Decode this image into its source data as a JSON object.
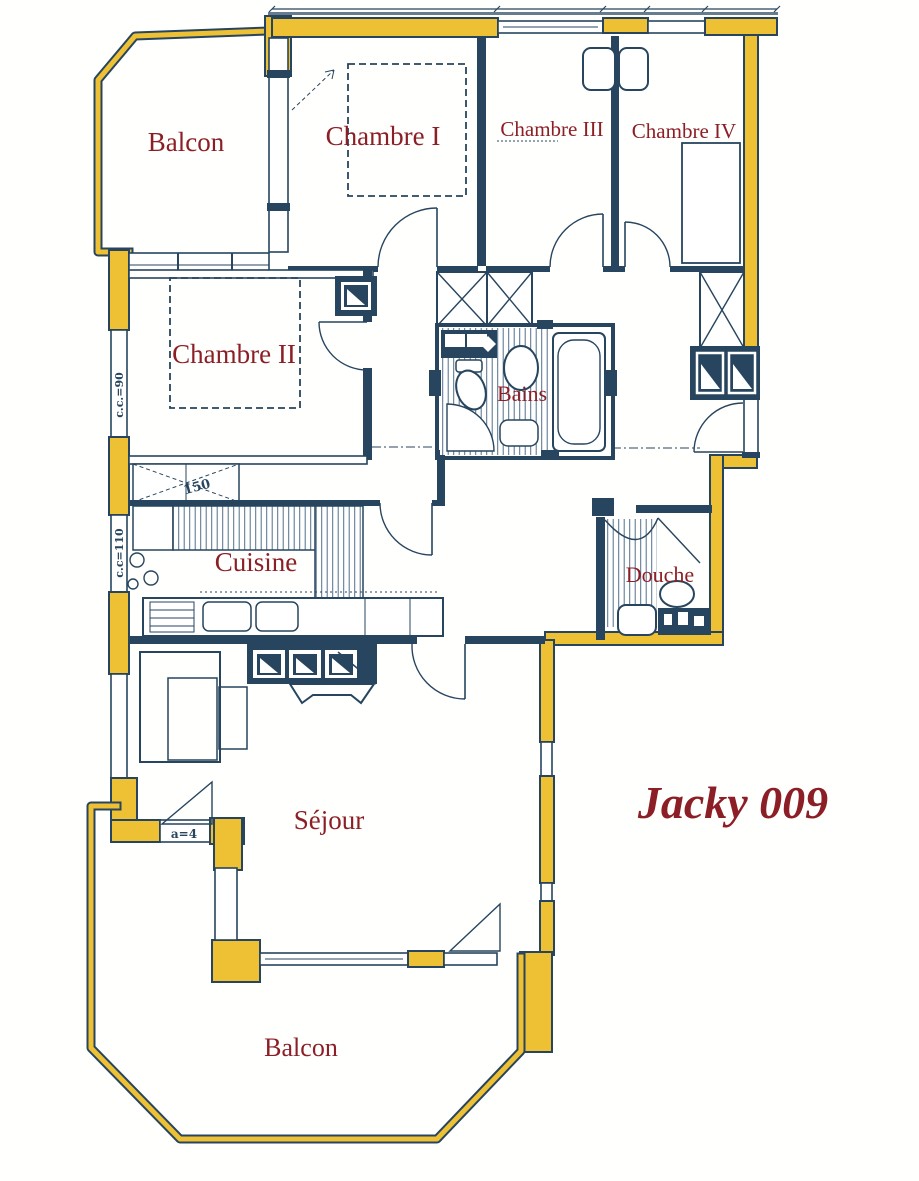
{
  "plan": {
    "title": "Jacky 009",
    "rooms": {
      "balcon_top": "Balcon",
      "chambre_1": "Chambre I",
      "chambre_3": "Chambre III",
      "chambre_4": "Chambre IV",
      "chambre_2": "Chambre II",
      "bains": "Bains",
      "cuisine": "Cuisine",
      "douche": "Douche",
      "sejour": "Séjour",
      "balcon_bottom": "Balcon"
    },
    "annotations": {
      "cc_90": "c.c.=90",
      "cc_110": "c.c=110",
      "dim_150": "150",
      "a_4": "a=4"
    },
    "colors": {
      "wall_yellow": "#EEC033",
      "ink_blue": "#27455E",
      "label_red": "#8C1F26"
    }
  }
}
